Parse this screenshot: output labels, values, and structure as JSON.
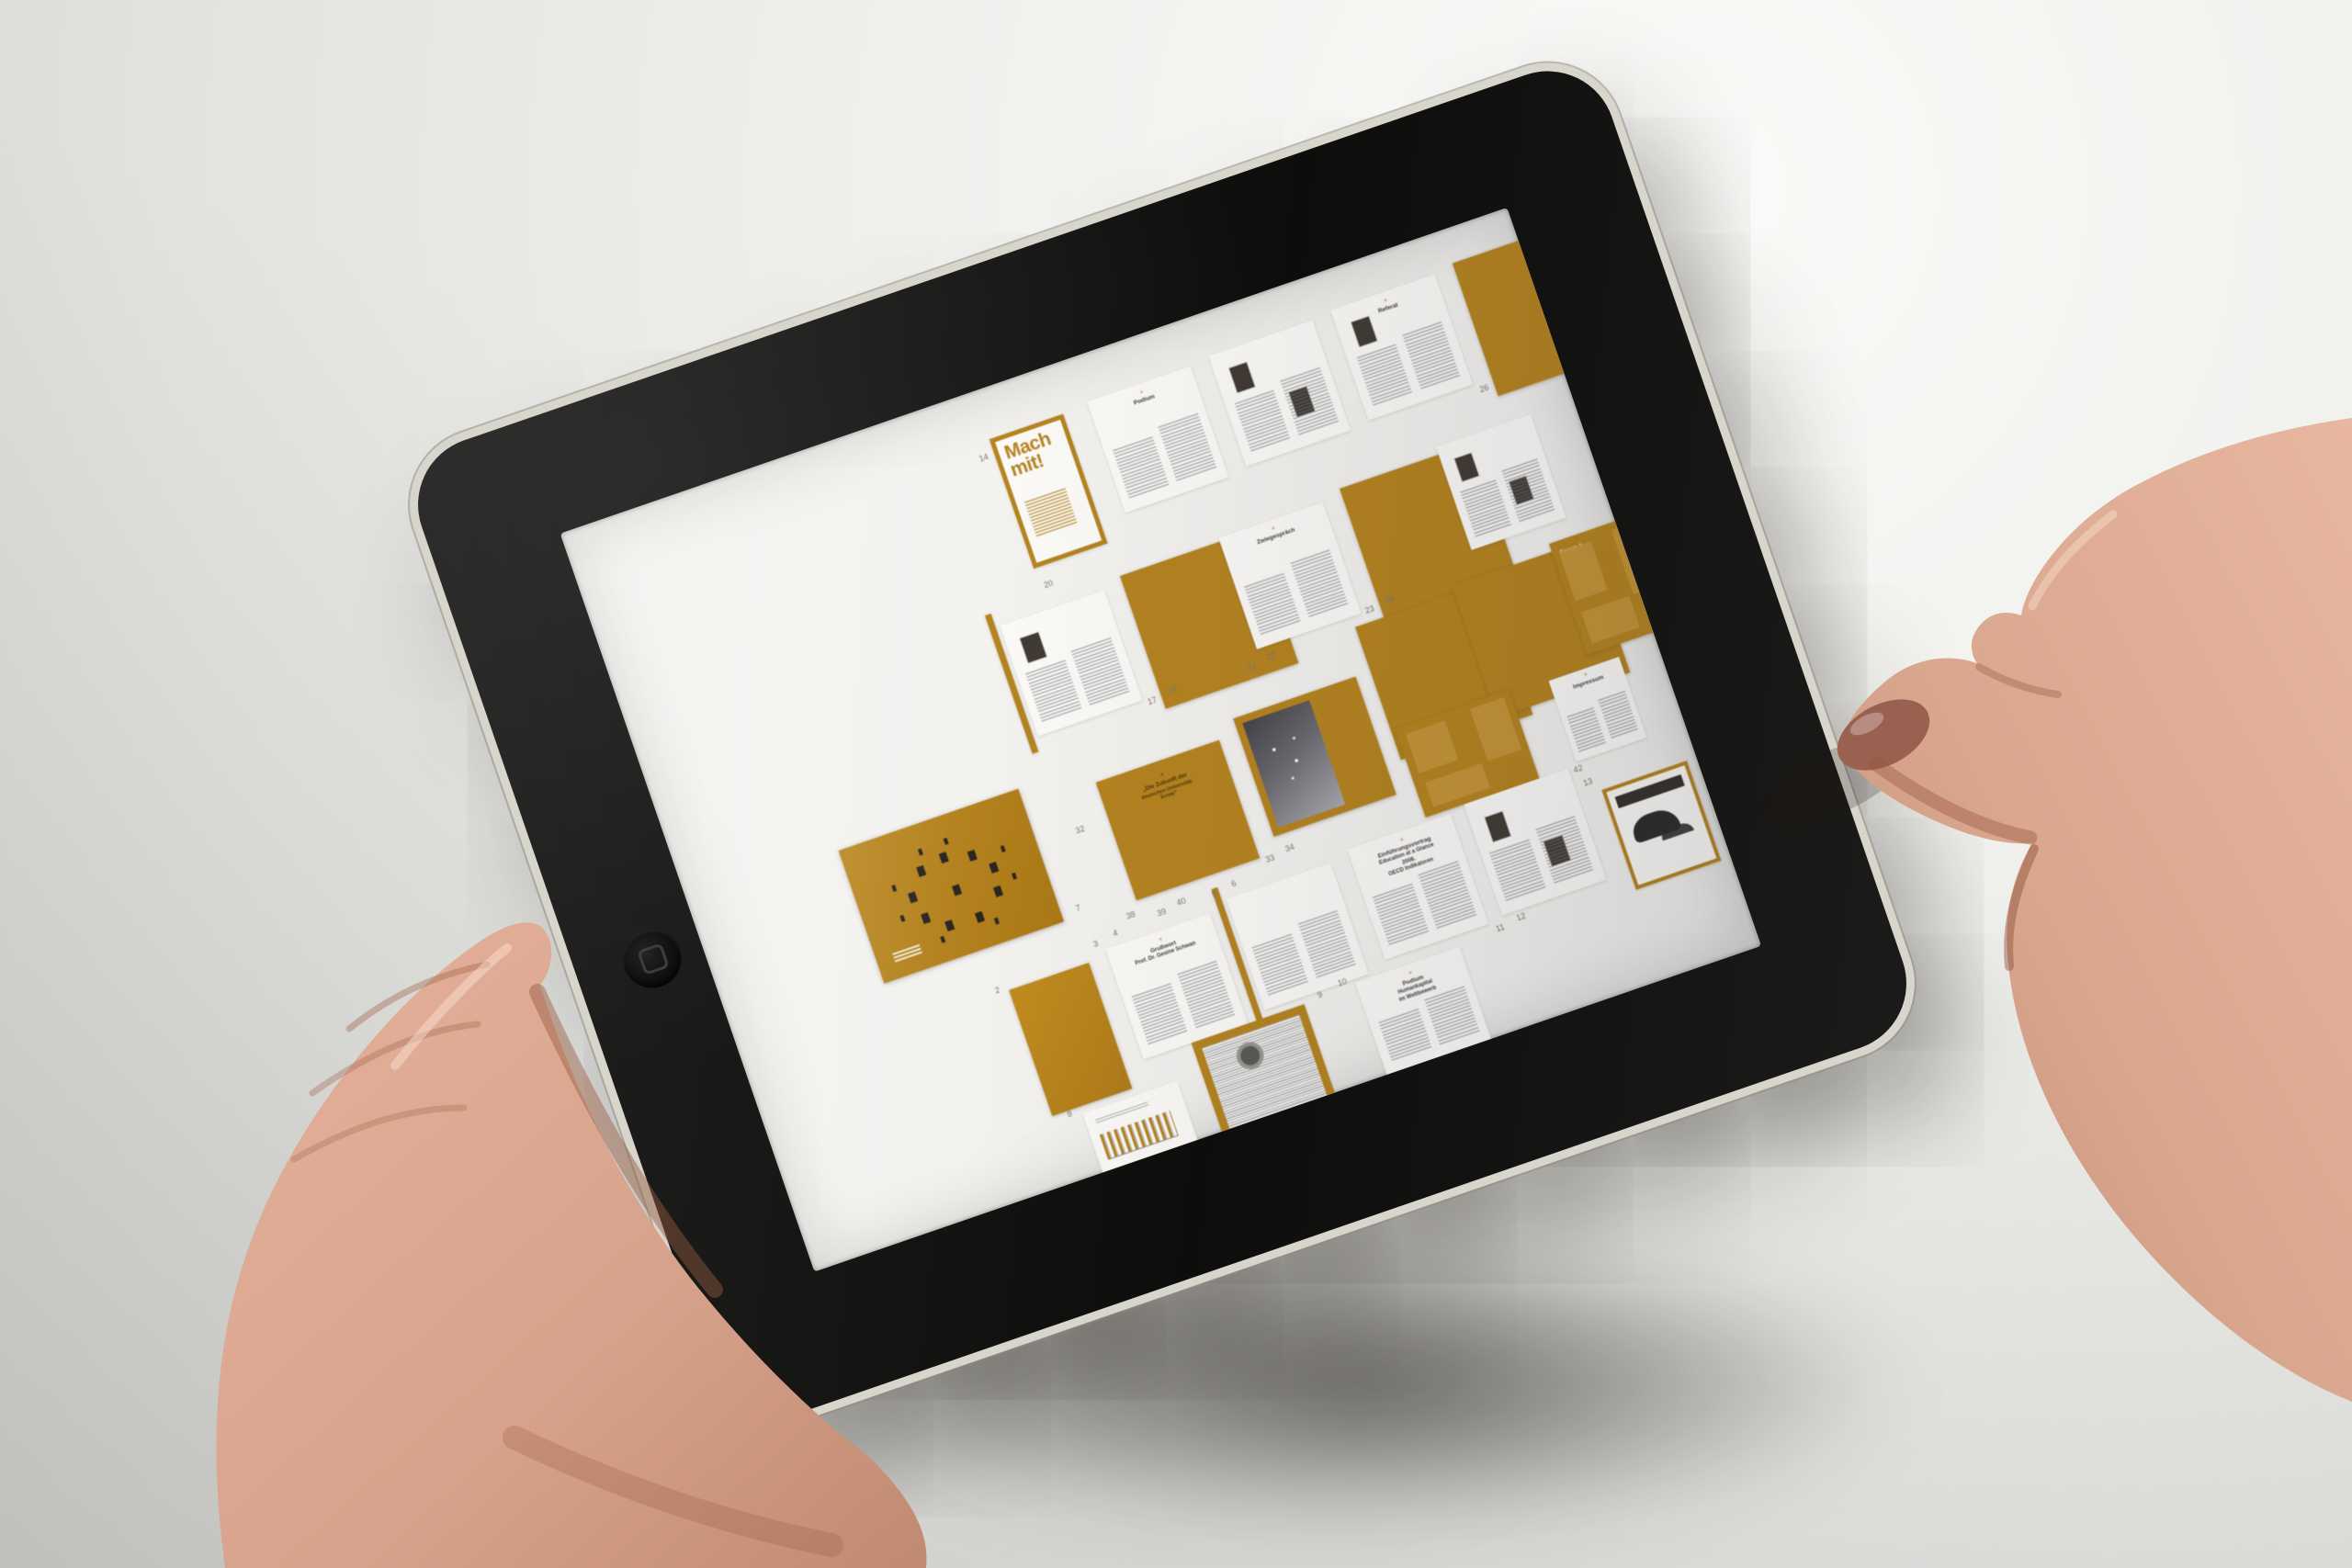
{
  "colors": {
    "accent_orange": "#b5831f",
    "bezel_black": "#111110",
    "rim_silver": "#d8d5cc",
    "screen_white": "#f3f2ef",
    "skin": "#d9a68e",
    "thumb_nail": "#9a6150",
    "background_wall": "#ededea"
  },
  "device": {
    "home_button_icon": "rounded-square"
  },
  "screen": {
    "thumbnails": [
      {
        "type": "num",
        "text": "14",
        "x": 42.0,
        "y": 8.0
      },
      {
        "type": "cover",
        "x": 43.6,
        "y": 6.5,
        "w": 7.8,
        "h": 17.5,
        "title": "Mach mit!"
      },
      {
        "type": "num",
        "text": "20",
        "x": 44.0,
        "y": 26.0
      },
      {
        "type": "text",
        "x": 54.0,
        "y": 6.0,
        "w": 11,
        "h": 15,
        "heading": [
          "Podium"
        ],
        "stripes": true
      },
      {
        "type": "text",
        "x": 67.0,
        "y": 5.5,
        "w": 11,
        "h": 15,
        "photos": 2,
        "stripes": true
      },
      {
        "type": "text",
        "x": 80.0,
        "y": 5.0,
        "w": 11,
        "h": 15,
        "heading": [
          "Referat"
        ],
        "photos": 1,
        "stripes": true
      },
      {
        "type": "framedphoto",
        "x": 93.0,
        "y": 4.5,
        "w": 7.0,
        "h": 14,
        "photo": "dark"
      },
      {
        "type": "num",
        "text": "26",
        "x": 91.5,
        "y": 20.5
      },
      {
        "type": "text",
        "x": 38.5,
        "y": 29.5,
        "w": 11,
        "h": 15,
        "divider": true,
        "photos": 1,
        "stripes": true
      },
      {
        "type": "framedphoto",
        "x": 51.5,
        "y": 28.5,
        "w": 8.5,
        "h": 13.5,
        "photo": "room"
      },
      {
        "type": "num",
        "text": "17",
        "x": 50.0,
        "y": 44.5
      },
      {
        "type": "num",
        "text": "18",
        "x": 52.2,
        "y": 44.0
      },
      {
        "type": "text",
        "x": 62.0,
        "y": 28.0,
        "w": 11,
        "h": 15,
        "heading": [
          "Zwiegespräch"
        ],
        "stripes": true
      },
      {
        "type": "num",
        "text": "21",
        "x": 60.5,
        "y": 44.5
      },
      {
        "type": "num",
        "text": "22",
        "x": 62.7,
        "y": 44.0
      },
      {
        "type": "framedphoto",
        "x": 75.0,
        "y": 27.0,
        "w": 8.5,
        "h": 14,
        "photo": "group"
      },
      {
        "type": "num",
        "text": "23",
        "x": 73.5,
        "y": 42.5
      },
      {
        "type": "num",
        "text": "24",
        "x": 75.7,
        "y": 42.0
      },
      {
        "type": "text",
        "x": 85.5,
        "y": 26.0,
        "w": 10,
        "h": 14,
        "photos": 2,
        "stripes": true
      },
      {
        "type": "framedphoto",
        "x": 72.0,
        "y": 44.5,
        "w": 9,
        "h": 15,
        "photo": "stairs"
      },
      {
        "type": "framedphoto",
        "x": 82.5,
        "y": 43.5,
        "w": 9,
        "h": 15,
        "photo": "star"
      },
      {
        "type": "orangespread",
        "x": 93.0,
        "y": 42.5,
        "w": 10,
        "h": 15,
        "boxes": true,
        "label": "Forum 1"
      },
      {
        "type": "figures",
        "x": 16.0,
        "y": 50.0,
        "w": 19,
        "h": 18
      },
      {
        "type": "num",
        "text": "7",
        "x": 36.5,
        "y": 66.5
      },
      {
        "type": "num",
        "text": "32",
        "x": 39.0,
        "y": 57.0
      },
      {
        "type": "orangespread",
        "x": 42.5,
        "y": 52.5,
        "w": 13,
        "h": 16,
        "heading": [
          "„Die Zukunft der",
          "deutschen Universität.",
          "Essay“"
        ]
      },
      {
        "type": "num",
        "text": "39",
        "x": 44.0,
        "y": 70.5
      },
      {
        "type": "num",
        "text": "40",
        "x": 46.2,
        "y": 70.0
      },
      {
        "type": "orangespread",
        "x": 57.5,
        "y": 50.5,
        "w": 13,
        "h": 16,
        "photo": "nightsky"
      },
      {
        "type": "num",
        "text": "33",
        "x": 56.0,
        "y": 68.5
      },
      {
        "type": "num",
        "text": "34",
        "x": 58.2,
        "y": 68.0
      },
      {
        "type": "orangespread",
        "x": 72.5,
        "y": 58.5,
        "w": 12,
        "h": 12,
        "boxes": true
      },
      {
        "type": "num",
        "text": "38",
        "x": 41.0,
        "y": 69.5
      },
      {
        "type": "text",
        "x": 88.5,
        "y": 59.0,
        "w": 7.5,
        "h": 11,
        "heading": [
          "Impressum"
        ],
        "stripes": true
      },
      {
        "type": "num",
        "text": "41",
        "x": 85.8,
        "y": 71.0
      },
      {
        "type": "num",
        "text": "42",
        "x": 88.0,
        "y": 70.5
      },
      {
        "type": "num",
        "text": "2",
        "x": 26.2,
        "y": 73.0
      },
      {
        "type": "orange",
        "x": 27.5,
        "y": 74.0,
        "w": 8.5,
        "h": 17
      },
      {
        "type": "text",
        "x": 38.0,
        "y": 73.0,
        "w": 11,
        "h": 15,
        "heading": [
          "Grußwort",
          "Prof. Dr. Gesine Schwan"
        ],
        "stripes": true
      },
      {
        "type": "num",
        "text": "3",
        "x": 37.0,
        "y": 71.5
      },
      {
        "type": "num",
        "text": "4",
        "x": 39.2,
        "y": 71.0
      },
      {
        "type": "text",
        "x": 51.0,
        "y": 72.0,
        "w": 11,
        "h": 15,
        "divider": true,
        "stripes": true
      },
      {
        "type": "num",
        "text": "5",
        "x": 49.8,
        "y": 70.5
      },
      {
        "type": "num",
        "text": "6",
        "x": 52.0,
        "y": 70.0
      },
      {
        "type": "text",
        "x": 64.0,
        "y": 71.0,
        "w": 11,
        "h": 15,
        "heading": [
          "Einführungsvortrag",
          "Education at a Glance",
          "2008.",
          "OECD Indikatoren"
        ],
        "stripes": true
      },
      {
        "type": "text",
        "x": 76.5,
        "y": 70.5,
        "w": 11,
        "h": 15,
        "photos": 2,
        "stripes": true
      },
      {
        "type": "num",
        "text": "11",
        "x": 75.5,
        "y": 86.5
      },
      {
        "type": "num",
        "text": "12",
        "x": 77.8,
        "y": 86.0
      },
      {
        "type": "ad",
        "x": 90.0,
        "y": 74.5,
        "w": 9,
        "h": 13.5
      },
      {
        "type": "num",
        "text": "13",
        "x": 88.5,
        "y": 72.5
      },
      {
        "type": "num",
        "text": "8",
        "x": 29.0,
        "y": 91.0
      },
      {
        "type": "chart",
        "x": 30.5,
        "y": 92.0,
        "w": 10,
        "h": 8
      },
      {
        "type": "news",
        "x": 43.0,
        "y": 88.0,
        "w": 12,
        "h": 12
      },
      {
        "type": "num",
        "text": "9",
        "x": 56.5,
        "y": 87.0
      },
      {
        "type": "num",
        "text": "10",
        "x": 58.8,
        "y": 86.5
      },
      {
        "type": "text",
        "x": 60.5,
        "y": 87.5,
        "w": 11,
        "h": 12.5,
        "heading": [
          "Podium",
          "Humankapital",
          "im Wettbewerb"
        ],
        "stripes": true
      }
    ]
  }
}
